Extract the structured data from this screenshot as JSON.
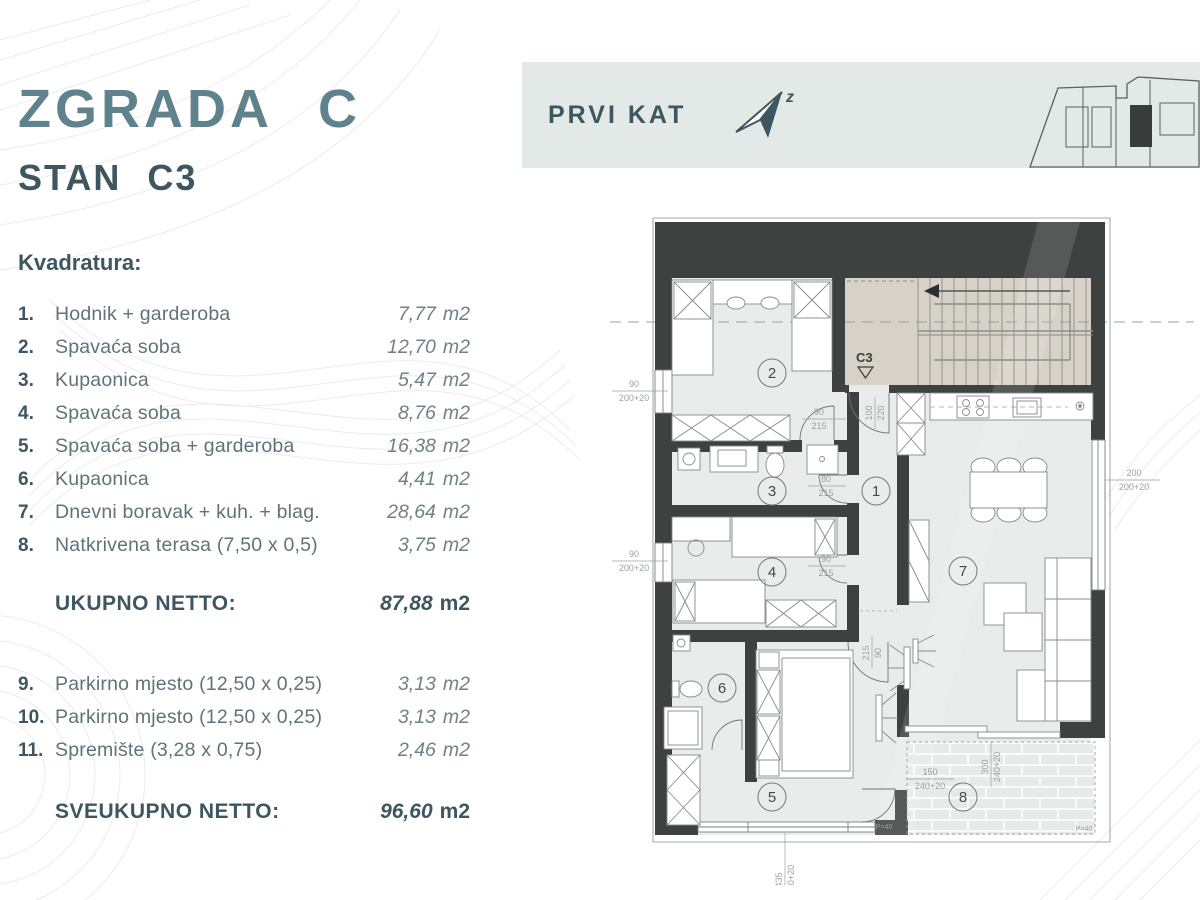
{
  "header": {
    "building": "ZGRADA C",
    "unit": "STAN C3"
  },
  "banner": {
    "floor": "PRVI KAT",
    "north_letter": "z"
  },
  "list": {
    "heading": "Kvadratura:",
    "items": [
      {
        "num": "1.",
        "name": "Hodnik + garderoba",
        "value": "7,77",
        "unit": "m2"
      },
      {
        "num": "2.",
        "name": "Spavaća soba",
        "value": "12,70",
        "unit": "m2"
      },
      {
        "num": "3.",
        "name": "Kupaonica",
        "value": "5,47",
        "unit": "m2"
      },
      {
        "num": "4.",
        "name": "Spavaća soba",
        "value": "8,76",
        "unit": "m2"
      },
      {
        "num": "5.",
        "name": "Spavaća soba + garderoba",
        "value": "16,38",
        "unit": "m2"
      },
      {
        "num": "6.",
        "name": "Kupaonica",
        "value": "4,41",
        "unit": "m2"
      },
      {
        "num": "7.",
        "name": "Dnevni boravak + kuh. + blag.",
        "value": "28,64",
        "unit": "m2"
      },
      {
        "num": "8.",
        "name": "Natkrivena terasa (7,50 x 0,5)",
        "value": "3,75",
        "unit": "m2"
      }
    ],
    "subtotal": {
      "label": "UKUPNO NETTO:",
      "value": "87,88",
      "unit": "m2"
    },
    "extra_items": [
      {
        "num": "9.",
        "name": "Parkirno mjesto (12,50 x 0,25)",
        "value": "3,13",
        "unit": "m2"
      },
      {
        "num": "10.",
        "name": "Parkirno mjesto (12,50 x 0,25)",
        "value": "3,13",
        "unit": "m2"
      },
      {
        "num": "11.",
        "name": "Spremište (3,28 x 0,75)",
        "value": "2,46",
        "unit": "m2"
      }
    ],
    "total": {
      "label": "SVEUKUPNO NETTO:",
      "value": "96,60",
      "unit": "m2"
    }
  },
  "plan": {
    "unit_label": "C3",
    "rooms": [
      "1",
      "2",
      "3",
      "4",
      "5",
      "6",
      "7",
      "8"
    ],
    "dims": {
      "win_left_top": {
        "a": "90",
        "b": "200+20"
      },
      "win_left_bottom": {
        "a": "90",
        "b": "200+20"
      },
      "door_room2": {
        "a": "90",
        "b": "215"
      },
      "entrance": {
        "a": "100",
        "b": "220"
      },
      "door_bath3": {
        "a": "80",
        "b": "215"
      },
      "door_room4": {
        "a": "90",
        "b": "215"
      },
      "door_room5": {
        "a": "215",
        "b": "90"
      },
      "terrace_left": {
        "a": "150",
        "b": "240+20"
      },
      "terrace_mid": {
        "a": "300",
        "b": "240+20"
      },
      "win_bottom": {
        "a": "435",
        "b": "200+20"
      },
      "win_right": {
        "a": "200",
        "b": "200+20"
      }
    },
    "p40_room": "P=40",
    "p40_terrace": "P=40"
  },
  "colors": {
    "accent_dark": "#3e565f",
    "accent_mid": "#5f828c",
    "banner_bg": "#e3e9e6",
    "wall": "#3d4140",
    "stairs": "#d6d2c7",
    "floor": "#e9eceb"
  }
}
